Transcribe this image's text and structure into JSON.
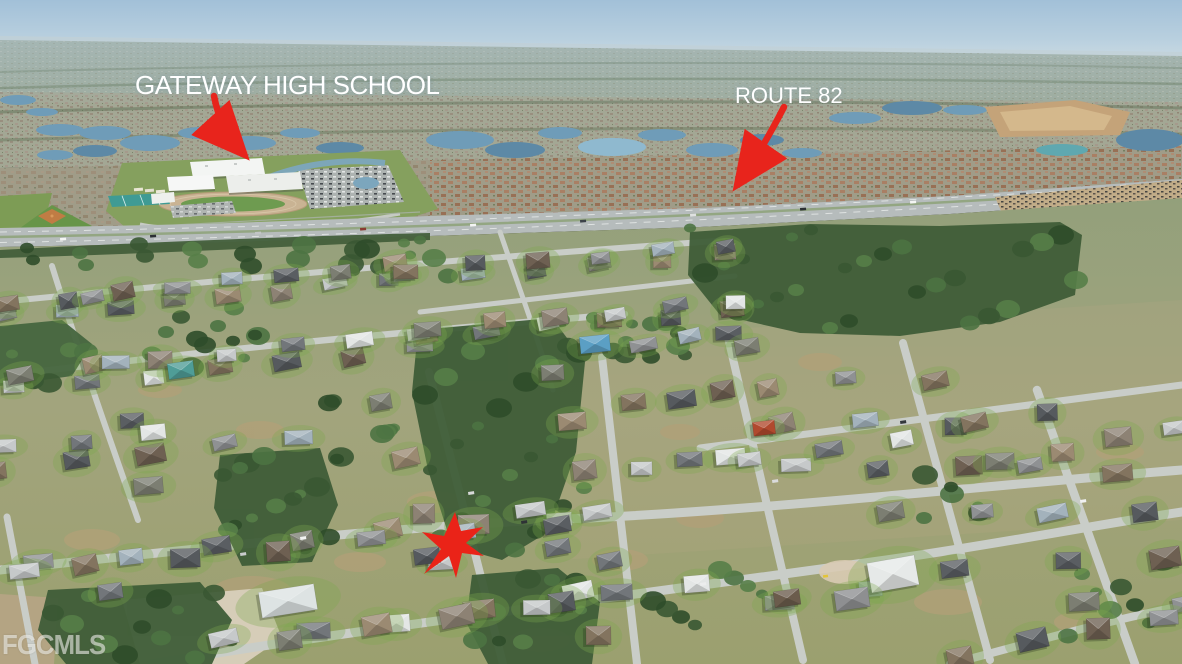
{
  "annotations": {
    "school": {
      "label": "GATEWAY HIGH SCHOOL",
      "color": "#ffffff"
    },
    "route": {
      "label": "ROUTE 82",
      "color": "#ffffff"
    },
    "arrow_color": "#e8241c",
    "marker_star_color": "#ea2318"
  },
  "watermark": {
    "text": "FGCMLS"
  }
}
